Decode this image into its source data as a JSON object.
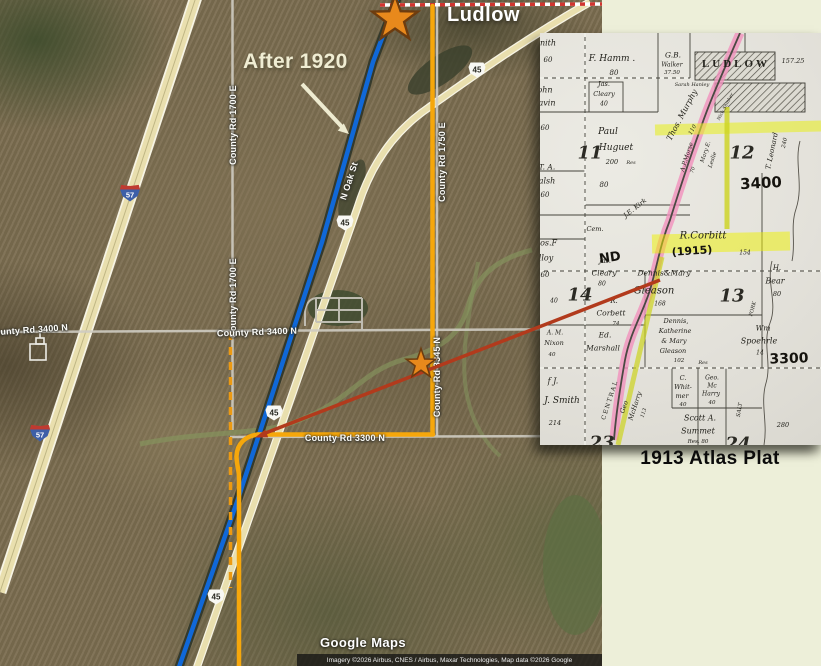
{
  "page": {
    "background": "#edefd9"
  },
  "annotations": {
    "ludlow": "Ludlow",
    "after_1920": "After 1920",
    "plat_caption": "1913 Atlas Plat"
  },
  "map": {
    "watermark": "Google Maps",
    "attribution": "Imagery ©2026 Airbus, CNES / Airbus, Maxar Technologies, Map data ©2026 Google",
    "road_labels": [
      {
        "t": "County Rd 1700 E",
        "x": 233,
        "y": 125,
        "r": -90
      },
      {
        "t": "County Rd 1700 E",
        "x": 233,
        "y": 298,
        "r": -90
      },
      {
        "t": "County Rd 1750 E",
        "x": 442,
        "y": 162,
        "r": -90
      },
      {
        "t": "County Rd 3345 N",
        "x": 437,
        "y": 377,
        "r": -90
      },
      {
        "t": "County Rd 3400 N",
        "x": 28,
        "y": 330,
        "r": -4
      },
      {
        "t": "County Rd 3400 N",
        "x": 257,
        "y": 332,
        "r": -2
      },
      {
        "t": "County Rd 3300 N",
        "x": 345,
        "y": 438,
        "r": 0
      },
      {
        "t": "N Oak St",
        "x": 349,
        "y": 181,
        "r": -72
      }
    ],
    "shields": {
      "us_route": [
        {
          "t": "45",
          "x": 477,
          "y": 70
        },
        {
          "t": "45",
          "x": 345,
          "y": 223
        },
        {
          "t": "45",
          "x": 274,
          "y": 413
        },
        {
          "t": "45",
          "x": 216,
          "y": 597
        }
      ],
      "interstate": [
        {
          "t": "57",
          "x": 130,
          "y": 193
        },
        {
          "t": "57",
          "x": 40,
          "y": 433
        }
      ]
    },
    "markers": [
      {
        "name": "star-ludlow",
        "x": 395,
        "y": 19,
        "s": 2.4
      },
      {
        "name": "star-field",
        "x": 421,
        "y": 364,
        "s": 1.55
      }
    ],
    "colors": {
      "blue_line": "#1068d8",
      "orange_line": "#f6a70b",
      "orange_dashed": "#ec9a12",
      "red_line": "#b23a1c",
      "star_fill": "#e8891c",
      "highway_tan": "#e9dfae"
    }
  },
  "plat": {
    "colors": {
      "railroad_pink": "#f191bd",
      "highlight_yellow": "#eef200",
      "highlight_green": "#cdd41f"
    },
    "labels": [
      {
        "t": "nith",
        "x": 8,
        "y": 10,
        "s": 8
      },
      {
        "t": "60",
        "x": 8,
        "y": 27,
        "s": 7
      },
      {
        "t": "F. Hamm .",
        "x": 72,
        "y": 26,
        "s": 9
      },
      {
        "t": "80",
        "x": 74,
        "y": 40,
        "s": 7
      },
      {
        "t": "G.B.",
        "x": 133,
        "y": 22,
        "s": 7.5
      },
      {
        "t": "Walker",
        "x": 132,
        "y": 32,
        "s": 6
      },
      {
        "t": "37.50",
        "x": 132,
        "y": 40,
        "s": 5.5
      },
      {
        "t": "LUDLOW",
        "x": 196,
        "y": 31,
        "s": 11,
        "c": "caps"
      },
      {
        "t": "157.25",
        "x": 253,
        "y": 28,
        "s": 6.5
      },
      {
        "t": "Sarah Hanley",
        "x": 152,
        "y": 52,
        "s": 5
      },
      {
        "t": "ohn",
        "x": 5,
        "y": 57,
        "s": 8
      },
      {
        "t": "avin",
        "x": 7,
        "y": 70,
        "s": 8
      },
      {
        "t": "Jas.",
        "x": 64,
        "y": 51,
        "s": 6.5
      },
      {
        "t": "Cleary",
        "x": 64,
        "y": 61,
        "s": 6.5
      },
      {
        "t": "40",
        "x": 64,
        "y": 71,
        "s": 6
      },
      {
        "t": "Thos. Murphy",
        "x": 142,
        "y": 82,
        "s": 8,
        "r": -62
      },
      {
        "t": "110",
        "x": 153,
        "y": 97,
        "s": 5.5,
        "r": -62
      },
      {
        "t": "Nick Shinker",
        "x": 186,
        "y": 74,
        "s": 4.5,
        "r": -62
      },
      {
        "t": "60",
        "x": 5,
        "y": 95,
        "s": 7
      },
      {
        "t": "Paul",
        "x": 68,
        "y": 99,
        "s": 9
      },
      {
        "t": "Huguet",
        "x": 76,
        "y": 115,
        "s": 9
      },
      {
        "t": "200",
        "x": 72,
        "y": 129,
        "s": 6.5
      },
      {
        "t": "Res",
        "x": 91,
        "y": 130,
        "s": 5
      },
      {
        "t": "11",
        "x": 50,
        "y": 120,
        "s": 18,
        "c": "num"
      },
      {
        "t": "12",
        "x": 202,
        "y": 120,
        "s": 18,
        "c": "num"
      },
      {
        "t": "A.P.Morse",
        "x": 147,
        "y": 124,
        "s": 6,
        "r": -72
      },
      {
        "t": "70",
        "x": 153,
        "y": 137,
        "s": 5,
        "r": -72
      },
      {
        "t": "Mary E.",
        "x": 166,
        "y": 119,
        "s": 5.5,
        "r": -72
      },
      {
        "t": "Leslie",
        "x": 173,
        "y": 127,
        "s": 5.5,
        "r": -72
      },
      {
        "t": "T. Leonard",
        "x": 232,
        "y": 118,
        "s": 7,
        "r": -78
      },
      {
        "t": "240",
        "x": 245,
        "y": 110,
        "s": 5.5,
        "r": -78
      },
      {
        "t": "3400",
        "x": 221,
        "y": 150,
        "s": 15,
        "c": "hand",
        "r": -3
      },
      {
        "t": "T. A.",
        "x": 7,
        "y": 134,
        "s": 7.5
      },
      {
        "t": "alsh",
        "x": 7,
        "y": 148,
        "s": 8
      },
      {
        "t": "60",
        "x": 5,
        "y": 162,
        "s": 7
      },
      {
        "t": "80",
        "x": 64,
        "y": 152,
        "s": 7
      },
      {
        "t": "J.E. Kirk",
        "x": 95,
        "y": 175,
        "s": 6.5,
        "r": -38
      },
      {
        "t": "Cem.",
        "x": 55,
        "y": 196,
        "s": 6.5
      },
      {
        "t": "ND",
        "x": 70,
        "y": 225,
        "s": 13,
        "c": "hand",
        "r": -8
      },
      {
        "t": "R.Corbitt",
        "x": 163,
        "y": 203,
        "s": 10
      },
      {
        "t": "(1915)",
        "x": 152,
        "y": 218,
        "s": 11,
        "c": "hand",
        "r": -4
      },
      {
        "t": "154",
        "x": 205,
        "y": 220,
        "s": 6
      },
      {
        "t": "hos.F",
        "x": 6,
        "y": 210,
        "s": 8
      },
      {
        "t": "lloy",
        "x": 6,
        "y": 225,
        "s": 8
      },
      {
        "t": "60",
        "x": 5,
        "y": 242,
        "s": 7
      },
      {
        "t": "Jas.",
        "x": 65,
        "y": 228,
        "s": 6.5
      },
      {
        "t": "Cleary",
        "x": 64,
        "y": 240,
        "s": 7.5
      },
      {
        "t": "80",
        "x": 62,
        "y": 251,
        "s": 6
      },
      {
        "t": "14",
        "x": 40,
        "y": 262,
        "s": 18,
        "c": "num"
      },
      {
        "t": "Dennis&Mary",
        "x": 124,
        "y": 240,
        "s": 7.5
      },
      {
        "t": "Gleason",
        "x": 114,
        "y": 258,
        "s": 10
      },
      {
        "t": "168",
        "x": 120,
        "y": 271,
        "s": 6
      },
      {
        "t": "13",
        "x": 192,
        "y": 263,
        "s": 18,
        "c": "num"
      },
      {
        "t": "H.",
        "x": 237,
        "y": 235,
        "s": 7
      },
      {
        "t": "Bear",
        "x": 235,
        "y": 248,
        "s": 8
      },
      {
        "t": "80",
        "x": 237,
        "y": 261,
        "s": 6.5
      },
      {
        "t": "FORK",
        "x": 213,
        "y": 276,
        "s": 5,
        "r": -75
      },
      {
        "t": "40",
        "x": 14,
        "y": 268,
        "s": 6
      },
      {
        "t": "R.",
        "x": 74,
        "y": 268,
        "s": 7
      },
      {
        "t": "Corbett",
        "x": 71,
        "y": 280,
        "s": 7.5
      },
      {
        "t": "74",
        "x": 76,
        "y": 291,
        "s": 5.5
      },
      {
        "t": "A. M.",
        "x": 15,
        "y": 300,
        "s": 6
      },
      {
        "t": "Nixon",
        "x": 14,
        "y": 310,
        "s": 6.5
      },
      {
        "t": "40",
        "x": 12,
        "y": 322,
        "s": 5.5
      },
      {
        "t": "Ed.",
        "x": 65,
        "y": 302,
        "s": 7.5
      },
      {
        "t": "Marshall",
        "x": 63,
        "y": 315,
        "s": 7.5
      },
      {
        "t": "Dennis,",
        "x": 136,
        "y": 288,
        "s": 6.5
      },
      {
        "t": "Katherine",
        "x": 135,
        "y": 298,
        "s": 6.5
      },
      {
        "t": "& Mary",
        "x": 134,
        "y": 308,
        "s": 6.5
      },
      {
        "t": "Gleason",
        "x": 133,
        "y": 318,
        "s": 6.5
      },
      {
        "t": "102",
        "x": 139,
        "y": 328,
        "s": 5.5
      },
      {
        "t": "Res",
        "x": 163,
        "y": 330,
        "s": 5
      },
      {
        "t": "Wm",
        "x": 223,
        "y": 295,
        "s": 7.5
      },
      {
        "t": "Spoehrle",
        "x": 219,
        "y": 308,
        "s": 8
      },
      {
        "t": "14",
        "x": 220,
        "y": 320,
        "s": 6
      },
      {
        "t": "3300",
        "x": 249,
        "y": 326,
        "s": 14,
        "c": "hand",
        "r": -2
      },
      {
        "t": "f J.",
        "x": 13,
        "y": 348,
        "s": 8
      },
      {
        "t": "J. Smith",
        "x": 22,
        "y": 368,
        "s": 9
      },
      {
        "t": "214",
        "x": 15,
        "y": 390,
        "s": 6.5
      },
      {
        "t": "CENTRAL",
        "x": 70,
        "y": 367,
        "s": 6,
        "r": -72,
        "c": "caps2"
      },
      {
        "t": "Geo",
        "x": 84,
        "y": 374,
        "s": 6.5,
        "r": -72
      },
      {
        "t": "McHarry",
        "x": 95,
        "y": 373,
        "s": 6.5,
        "r": -72
      },
      {
        "t": "113",
        "x": 104,
        "y": 380,
        "s": 5,
        "r": -72
      },
      {
        "t": "C.",
        "x": 143,
        "y": 345,
        "s": 6.5
      },
      {
        "t": "Whit-",
        "x": 143,
        "y": 354,
        "s": 6.5
      },
      {
        "t": "mer",
        "x": 142,
        "y": 363,
        "s": 6.5
      },
      {
        "t": "40",
        "x": 143,
        "y": 372,
        "s": 5.5
      },
      {
        "t": "Geo.",
        "x": 172,
        "y": 345,
        "s": 6
      },
      {
        "t": "Mc",
        "x": 172,
        "y": 353,
        "s": 6
      },
      {
        "t": "Harry",
        "x": 171,
        "y": 361,
        "s": 6
      },
      {
        "t": "40",
        "x": 172,
        "y": 370,
        "s": 5.5
      },
      {
        "t": "SALT",
        "x": 200,
        "y": 377,
        "s": 5.5,
        "r": -80
      },
      {
        "t": "Scott A.",
        "x": 160,
        "y": 385,
        "s": 8
      },
      {
        "t": "Summet",
        "x": 158,
        "y": 398,
        "s": 8
      },
      {
        "t": "Res. 80",
        "x": 158,
        "y": 409,
        "s": 5.5
      },
      {
        "t": "280",
        "x": 243,
        "y": 392,
        "s": 6.5
      },
      {
        "t": "23",
        "x": 62,
        "y": 410,
        "s": 18,
        "c": "num"
      },
      {
        "t": "24",
        "x": 198,
        "y": 411,
        "s": 18,
        "c": "num"
      }
    ]
  }
}
